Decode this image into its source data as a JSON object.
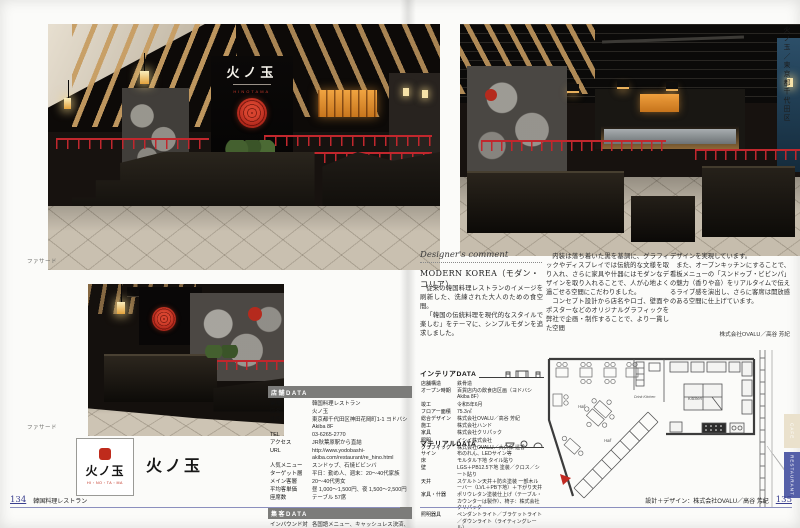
{
  "colors": {
    "accent-red": "#c1272d",
    "footer-rule": "#8b8fbe",
    "tab-blue": "#5560a8",
    "tab-cream": "#eae1cc",
    "wood": "#c79d62",
    "emblem-red": "#b52a1d"
  },
  "spread": {
    "left_page_number": "134",
    "left_footer_label": "韓国料理レストラン",
    "right_page_number": "135",
    "right_footer_label": "設計＋デザイン：株式会社OVALU／高谷 芳紀",
    "side_caption_vertical": "火ノ玉／東京都千代田区",
    "photo_caption_1": "ファサード",
    "photo_caption_2": "ファサード",
    "tab_cafe": "CAFE",
    "tab_restaurant": "RESTAURANT"
  },
  "restaurant": {
    "sign_jp": "火ノ玉",
    "sign_roman": "HINOTAMA",
    "logo_jp": "火ノ玉",
    "logo_roman": "HI・NO・TA・MA",
    "name_label": "火ノ玉"
  },
  "shop_data": {
    "title": "店舗DATA",
    "rows": [
      {
        "label": "業種",
        "value": "韓国料理レストラン"
      },
      {
        "label": "店名",
        "value": "火ノ玉"
      },
      {
        "label": "住所",
        "value": "東京都千代田区神田花岡町1-1 ヨドバシAkiba 8F"
      },
      {
        "label": "TEL",
        "value": "03-6265-2770"
      },
      {
        "label": "アクセス",
        "value": "JR秋葉原駅から直結"
      },
      {
        "label": "URL",
        "value": "http://www.yodobashi-akiba.com/restaurant/re_hino.html"
      },
      {
        "label": "人気メニュー",
        "value": "スンドゥブ、石焼ビビンバ"
      },
      {
        "label": "ターゲット層",
        "value": "平日：勤め人、週末：20〜40代家族"
      },
      {
        "label": "メイン客層",
        "value": "20〜40代男女"
      },
      {
        "label": "平均客単価",
        "value": "昼 1,000〜1,500円、夜 1,500〜2,500円"
      },
      {
        "label": "座席数",
        "value": "テーブル 57席"
      }
    ],
    "sub_title": "集客DATA",
    "sub_rows": [
      {
        "label": "インバウンド対応",
        "value": "各国語メニュー、キャッシュレス決済、Wi-Fi、外国人スタッフ"
      }
    ]
  },
  "comment": {
    "heading": "Designer's comment",
    "title": "MODERN KOREA（モダン・コリア）",
    "col1_p1": "従来の韓国料理レストランのイメージを刷新した、洗練された大人のための食空間。",
    "col1_p2": "「韓国の伝統料理を現代的なスタイルで楽しむ」をテーマに、シンプルモダンを追求しました。",
    "col2_p1": "内装は落ち着いた黒を基調に、グラフィックやディスプレイでは伝統的な文様を取り入れ、さらに家具や什器にはモダンなデザインを取り入れることで、人が心地よく過ごせる空間にこだわりました。",
    "col2_p2": "コンセプト設計から店名やロゴ、壁面やポスターなどのオリジナルグラフィックを弊社で企画・制作することで、より一貫した空間",
    "col3_p1": "デザインを実現しています。",
    "col3_p2": "また、オープンキッチンにすることで、看板メニューの「スンドゥブ・ビビンパ」の魅力（香りや音）をリアルタイムで伝えるライブ感を演出し、さらに客席は開放感のある空間に仕上げています。",
    "credit": "株式会社OVALU／高谷 芳紀"
  },
  "interior_data": {
    "title": "インテリアDATA",
    "rows": [
      {
        "label": "店舗構造",
        "value": "鉄骨造"
      },
      {
        "label": "オープン時期",
        "value": "百貨店内の飲食店区画（ヨドバシAkiba 8F）"
      },
      {
        "label": "竣工",
        "value": "令和5年6月"
      },
      {
        "label": "フロアー面積",
        "value": "75.3㎡"
      },
      {
        "label": "総合デザイン",
        "value": "株式会社OVALU／高谷 芳紀"
      },
      {
        "label": "施工",
        "value": "株式会社ハンド"
      },
      {
        "label": "家具",
        "value": "株式会社クリパック"
      },
      {
        "label": "照明",
        "value": "イシイ株式会社"
      },
      {
        "label": "グラフィック",
        "value": "株式会社OVALU／大久保 遥香"
      }
    ]
  },
  "material_data": {
    "title": "マテリアルDATA",
    "rows": [
      {
        "label": "サイン",
        "value": "布のれん、LEDサイン等"
      },
      {
        "label": "床",
        "value": "モルタル下地 タイル貼り"
      },
      {
        "label": "壁",
        "value": "LGS＋PB12.5下地 塗装／クロス／シート貼り"
      },
      {
        "label": "天井",
        "value": "スケルトン天井＋防炎塗装 一部木ルーバー（LVL＋PB下地）＋下がり天井"
      },
      {
        "label": "家具・什器",
        "value": "ポリウレタン塗装仕上げ（テーブル・カウンターは製作）、椅子：株式会社クリパック"
      },
      {
        "label": "照明器具",
        "value": "ペンダントライト／ブラケットライト／ダウンライト（ライティングレール）"
      },
      {
        "label": "厨房機器",
        "value": "ビビンバグリル、ハースグリラー、スチコン、冷蔵庫、冷凍庫、製氷機"
      }
    ]
  },
  "plan": {
    "hall1": "Hall",
    "hall2": "Hall",
    "drink": "Drink Kitchen",
    "kitchen": "Kitchen"
  }
}
